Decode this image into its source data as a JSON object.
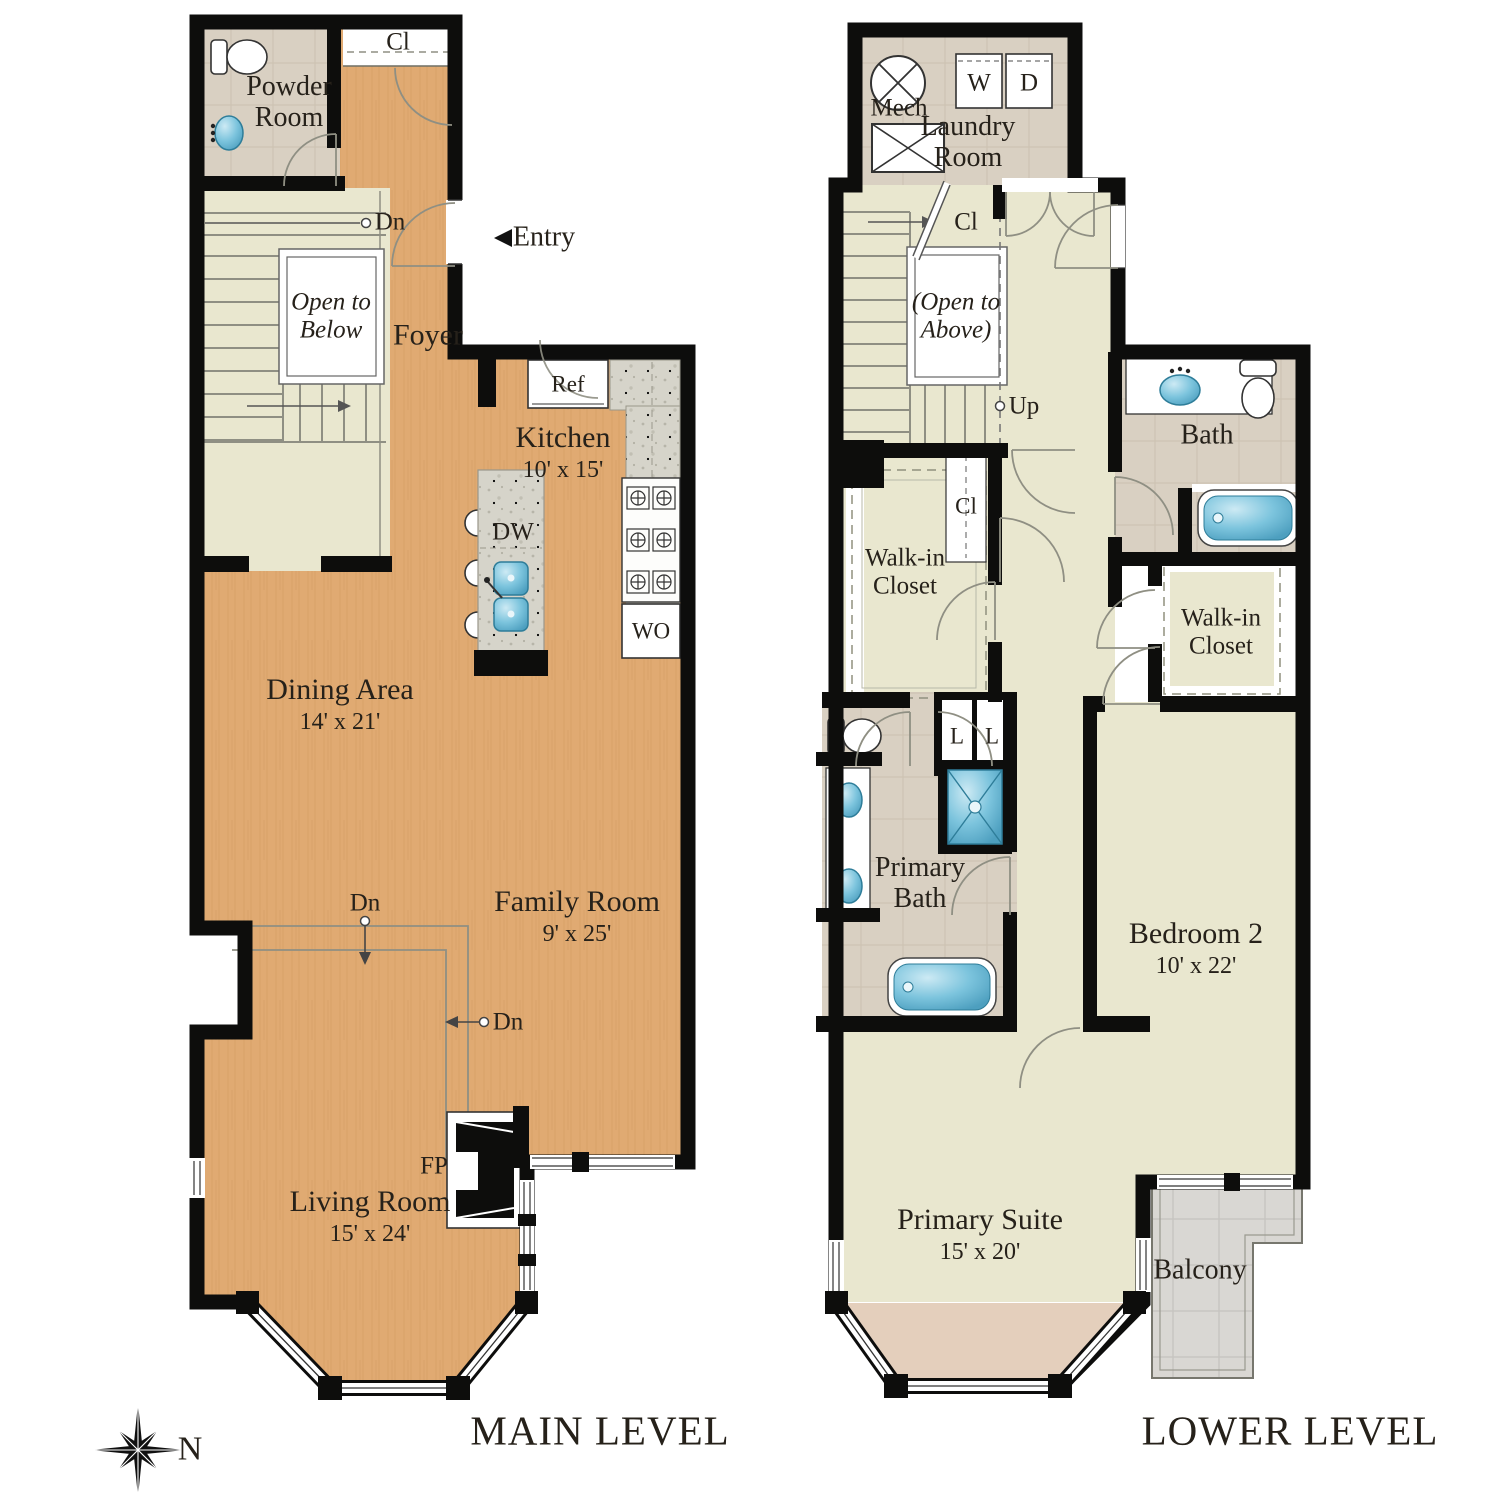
{
  "colors": {
    "wall": "#0d0d0c",
    "wood_floor": "#e0aa72",
    "pale_floor": "#e9e7cf",
    "tile_floor": "#d9d0c2",
    "granite": "#d6d4ca",
    "fixture_blue": "#7cc4dd",
    "balcony_tile": "#d8d6d2",
    "bay_floor": "#e4cfbc",
    "label_ink": "#26211a"
  },
  "main_level": {
    "title": "MAIN LEVEL",
    "rooms": {
      "powder_room": {
        "name": "Powder Room"
      },
      "foyer": {
        "name": "Foyer"
      },
      "kitchen": {
        "name": "Kitchen",
        "dim": "10' x 15'"
      },
      "dining": {
        "name": "Dining Area",
        "dim": "14' x 21'"
      },
      "family": {
        "name": "Family Room",
        "dim": "9' x 25'"
      },
      "living": {
        "name": "Living Room",
        "dim": "15' x 24'"
      }
    },
    "markers": {
      "closet": "Cl",
      "dn_stairs": "Dn",
      "entry": "Entry",
      "open_to_below": "Open to Below",
      "ref": "Ref",
      "dw": "DW",
      "wo": "WO",
      "dn_step_1": "Dn",
      "dn_step_2": "Dn",
      "fireplace": "FP"
    }
  },
  "lower_level": {
    "title": "LOWER LEVEL",
    "rooms": {
      "laundry": {
        "name": "Laundry Room"
      },
      "bath": {
        "name": "Bath"
      },
      "walkin_left": {
        "name": "Walk-in Closet"
      },
      "walkin_right": {
        "name": "Walk-in Closet"
      },
      "primary_bath": {
        "name": "Primary Bath"
      },
      "bedroom2": {
        "name": "Bedroom 2",
        "dim": "10' x 22'"
      },
      "primary_suite": {
        "name": "Primary Suite",
        "dim": "15' x 20'"
      },
      "balcony": {
        "name": "Balcony"
      }
    },
    "markers": {
      "mech": "Mech",
      "washer": "W",
      "dryer": "D",
      "closet_hall": "Cl",
      "open_to_above": "(Open to Above)",
      "up": "Up",
      "closet_small": "Cl",
      "linen_1": "L",
      "linen_2": "L"
    }
  },
  "compass": {
    "north": "N"
  }
}
